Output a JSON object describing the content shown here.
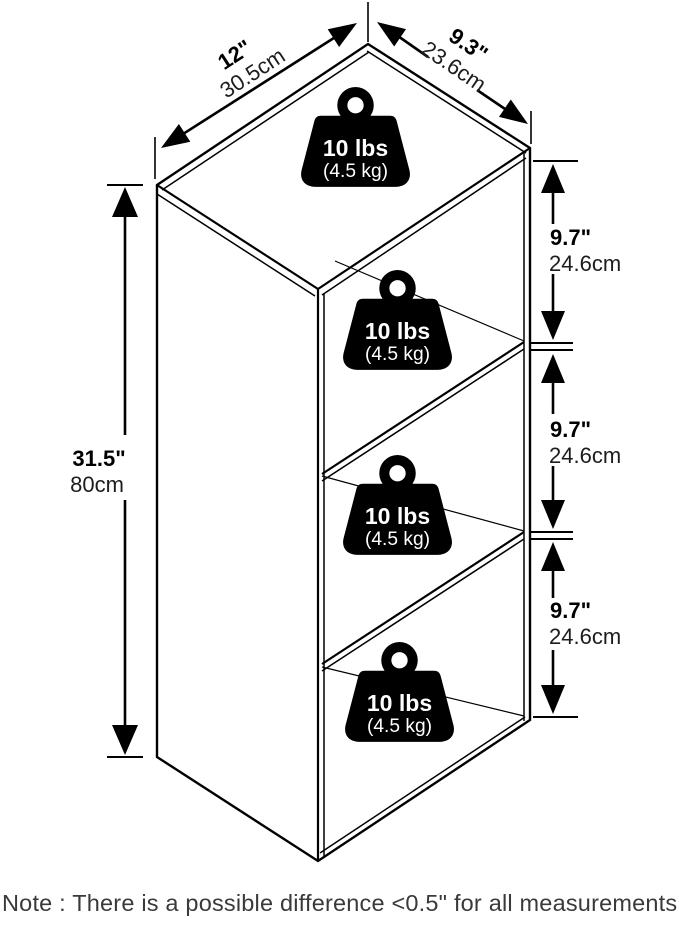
{
  "diagram_title": "3-tier bookcase dimension diagram",
  "dimensions": {
    "width": {
      "inches": "12\"",
      "cm": "30.5cm"
    },
    "depth": {
      "inches": "9.3\"",
      "cm": "23.6cm"
    },
    "height": {
      "inches": "31.5\"",
      "cm": "80cm"
    },
    "shelves": [
      {
        "inches": "9.7\"",
        "cm": "24.6cm"
      },
      {
        "inches": "9.7\"",
        "cm": "24.6cm"
      },
      {
        "inches": "9.7\"",
        "cm": "24.6cm"
      }
    ]
  },
  "weight_capacity": {
    "pounds": "10 lbs",
    "kilograms": "(4.5 kg)"
  },
  "note": "Note : There is a possible difference <0.5\" for all measurements.",
  "colors": {
    "line": "#000000",
    "text": "#000000",
    "note_text": "#3a3a3a",
    "background": "#ffffff"
  }
}
